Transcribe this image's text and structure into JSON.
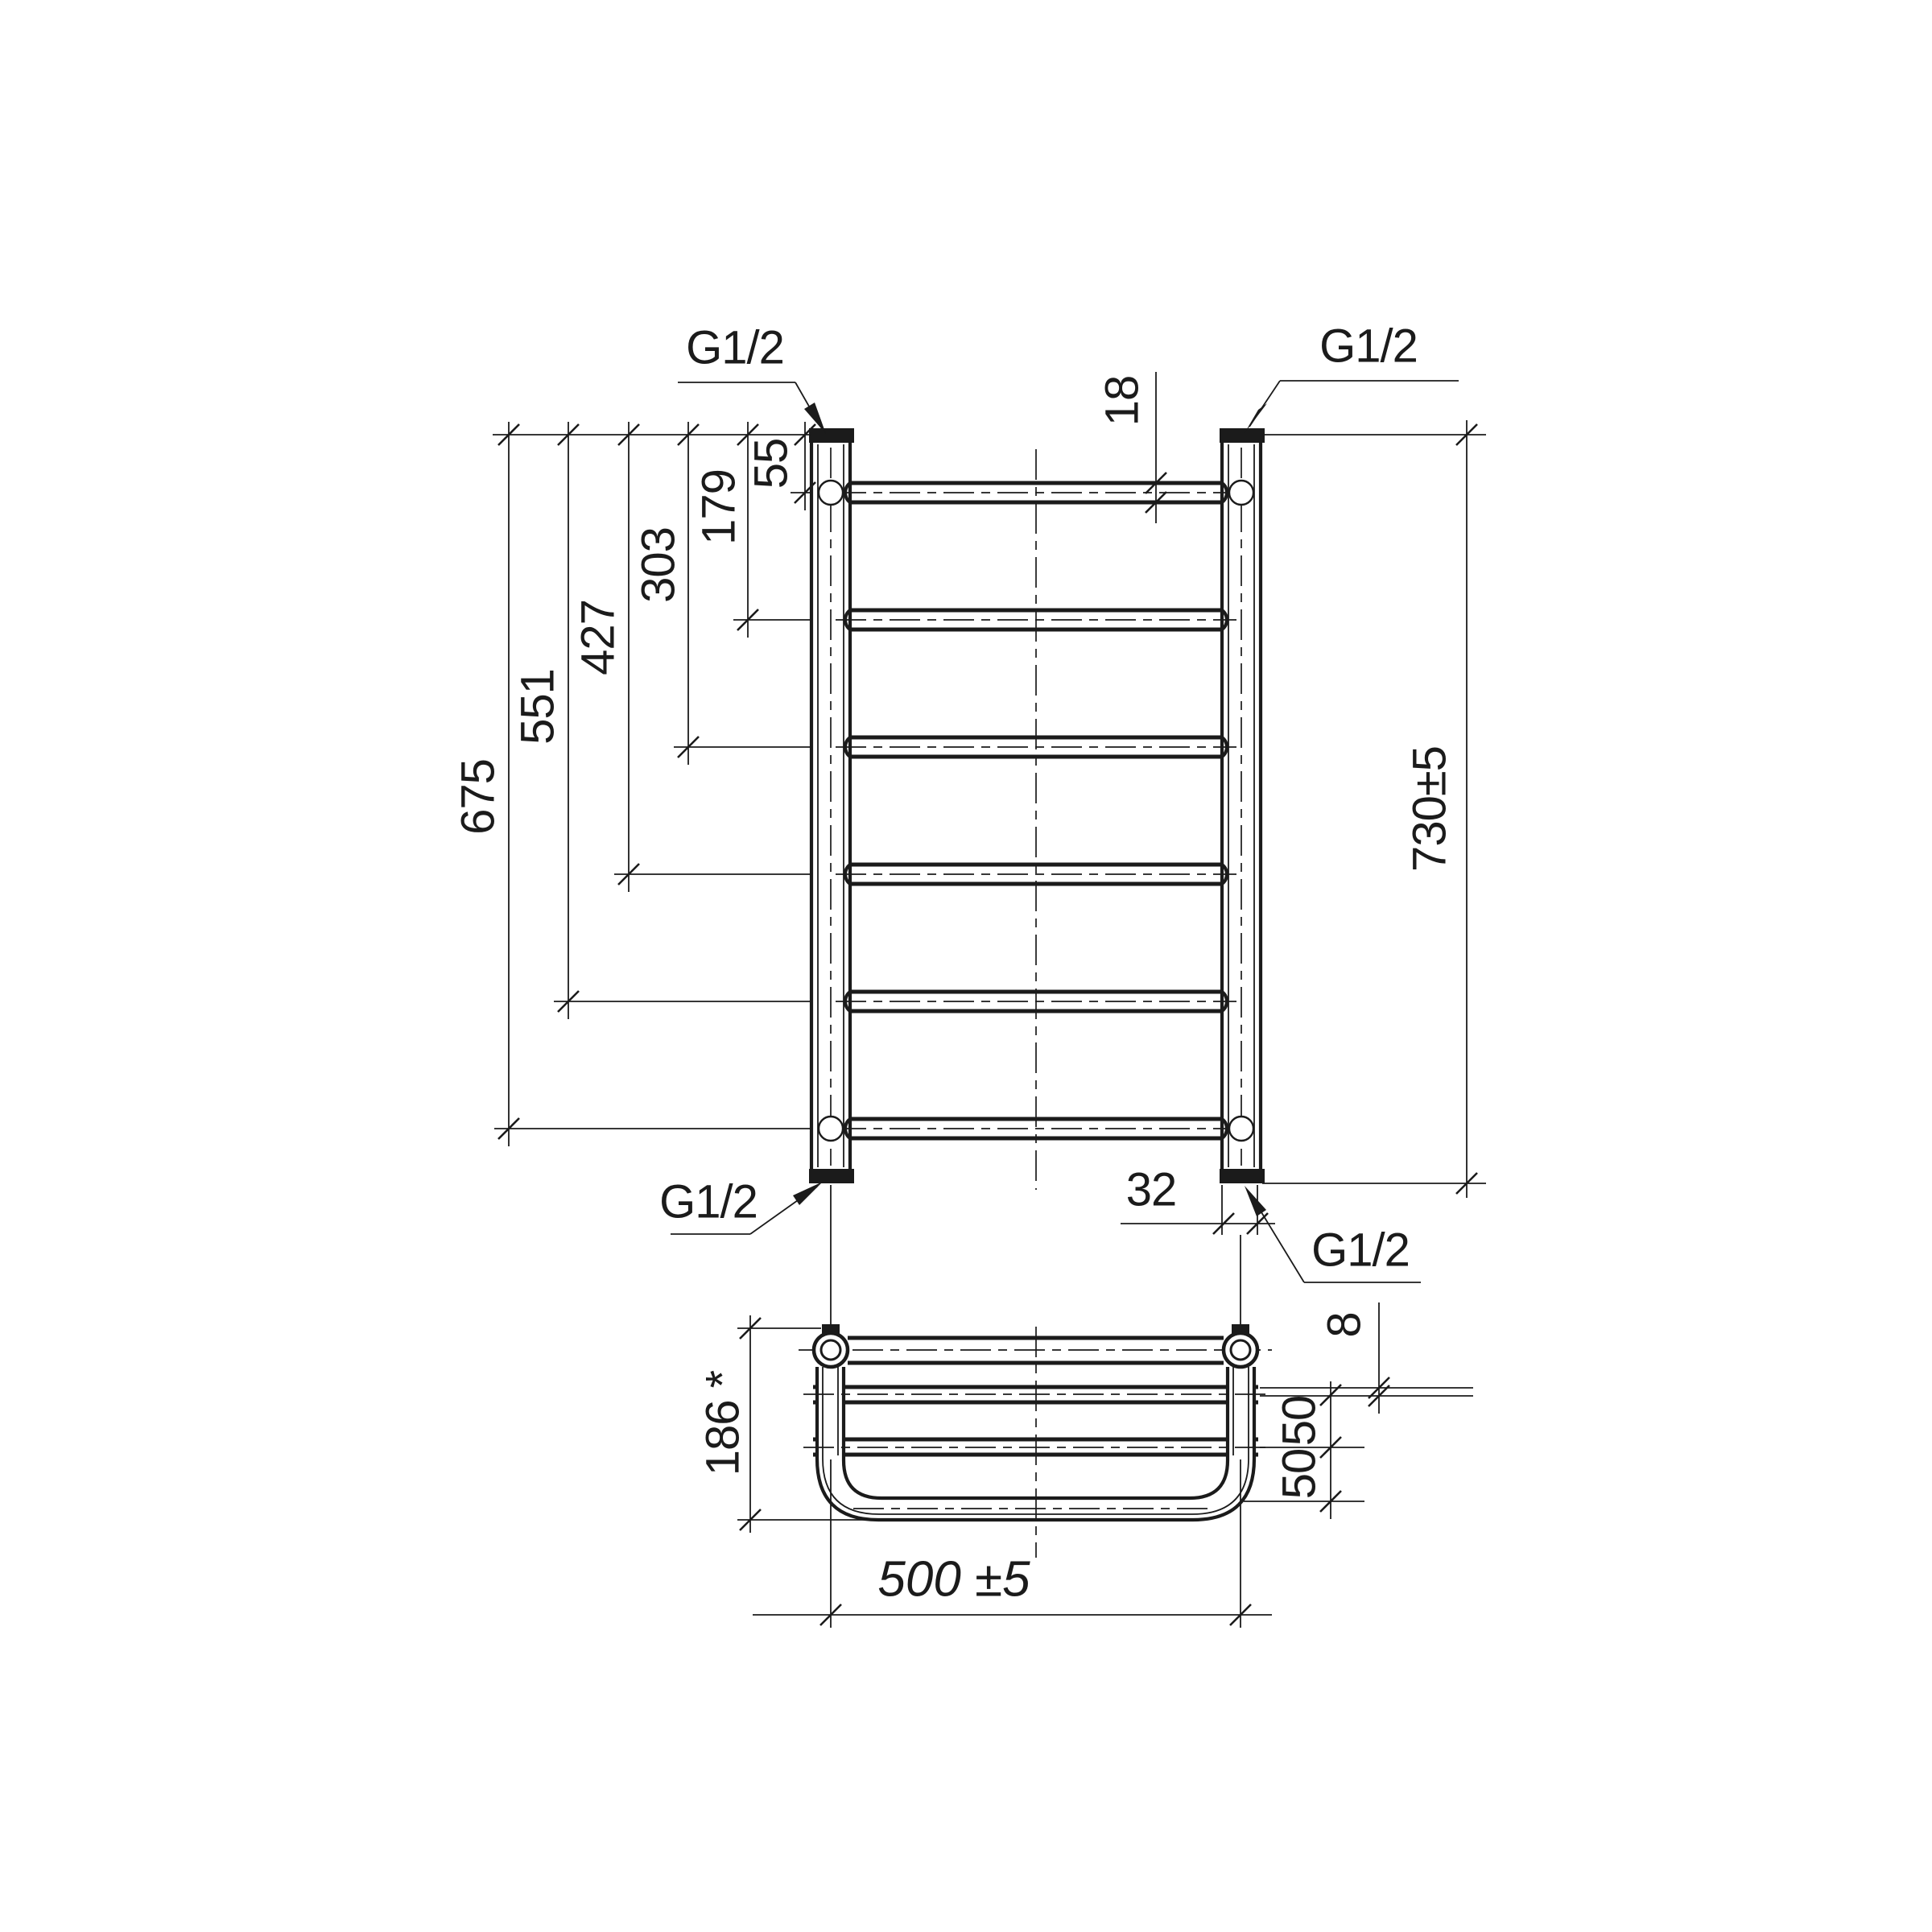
{
  "connections": {
    "top_left": "G1/2",
    "top_right": "G1/2",
    "bottom_left": "G1/2",
    "bottom_right": "G1/2"
  },
  "front_view": {
    "rung_offsets": [
      "675",
      "551",
      "427",
      "303",
      "179",
      "55"
    ],
    "overall_height": "730±5",
    "rung_diameter": "18",
    "post_width": "32"
  },
  "bottom_view": {
    "depth": "186 *",
    "shelf_offset": "8",
    "shelf_spacing_upper": "50",
    "shelf_spacing_lower": "50",
    "width": "500 ±5"
  },
  "line_color": "#1b1b1b",
  "background_color": "#ffffff"
}
